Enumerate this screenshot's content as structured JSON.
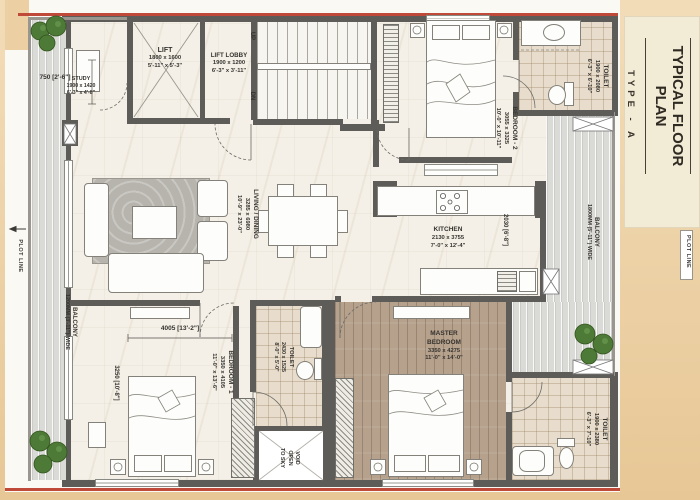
{
  "sidebar": {
    "title": "TYPICAL FLOOR PLAN",
    "subtitle": "TYPE - A",
    "plot_line": "PLOT LINE"
  },
  "annotations": {
    "plot_line_left": "PLOT LINE",
    "dim_750": "750 [2'-6\"]",
    "dim_4005": "4005 [13'-2\"]",
    "dim_3250": "3250 [10'-8\"]",
    "dim_2030": "2030 [6'-8\"]",
    "up": "UP",
    "dn": "DN"
  },
  "rooms": {
    "study": {
      "name": "STUDY",
      "mm": "1900 x 1420",
      "ft": "6'-3\" x 4'-8\""
    },
    "lift": {
      "name": "LIFT",
      "mm": "1800 x 1600",
      "ft": "5'-11\" x 5'-3\""
    },
    "lift_lobby": {
      "name": "LIFT LOBBY",
      "mm": "1900 x 1200",
      "ft": "6'-3\" x 3'-11\""
    },
    "bedroom2": {
      "name": "BEDROOM - 2",
      "mm": "3055 x 3325",
      "ft": "10'-0\" x 10'-11\""
    },
    "toilet_top": {
      "name": "TOILET",
      "mm": "1900 x 2080",
      "ft": "6'-3\" x 6'-10\""
    },
    "living": {
      "name": "LIVING / DINING",
      "mm": "3285 x 6980",
      "ft": "10'-9\" x 23'-0\""
    },
    "kitchen": {
      "name": "KITCHEN",
      "mm": "2130 x 3755",
      "ft": "7'-0\" x 12'-4\""
    },
    "bedroom1": {
      "name": "BEDROOM - 1",
      "mm": "3350 x 4105",
      "ft": "11'-0\" x 13'-6\""
    },
    "toilet_mid": {
      "name": "TOILET",
      "mm": "2430 x 1525",
      "ft": "8'-0\" x 5'-0\""
    },
    "master": {
      "name": "MASTER BEDROOM",
      "mm": "3350 x 4275",
      "ft": "11'-0\" x 14'-0\""
    },
    "toilet_master": {
      "name": "TOILET",
      "mm": "1900 x 2380",
      "ft": "6'-3\" x 7'-10\""
    },
    "balcony_left": {
      "name": "BALCONY",
      "width": "1200MM (3'-11\") WIDE"
    },
    "balcony_right": {
      "name": "BALCONY",
      "width": "1800MM (5'-11\") WIDE"
    },
    "void": {
      "l1": "VOID",
      "l2": "OPEN",
      "l3": "TO SKY"
    }
  },
  "colors": {
    "plot_line_red": "#bf4a3a",
    "wall_gray": "#5d5c58",
    "sidebar_cream": "#f2ebd6",
    "page_peach": "#ecd0a4"
  }
}
